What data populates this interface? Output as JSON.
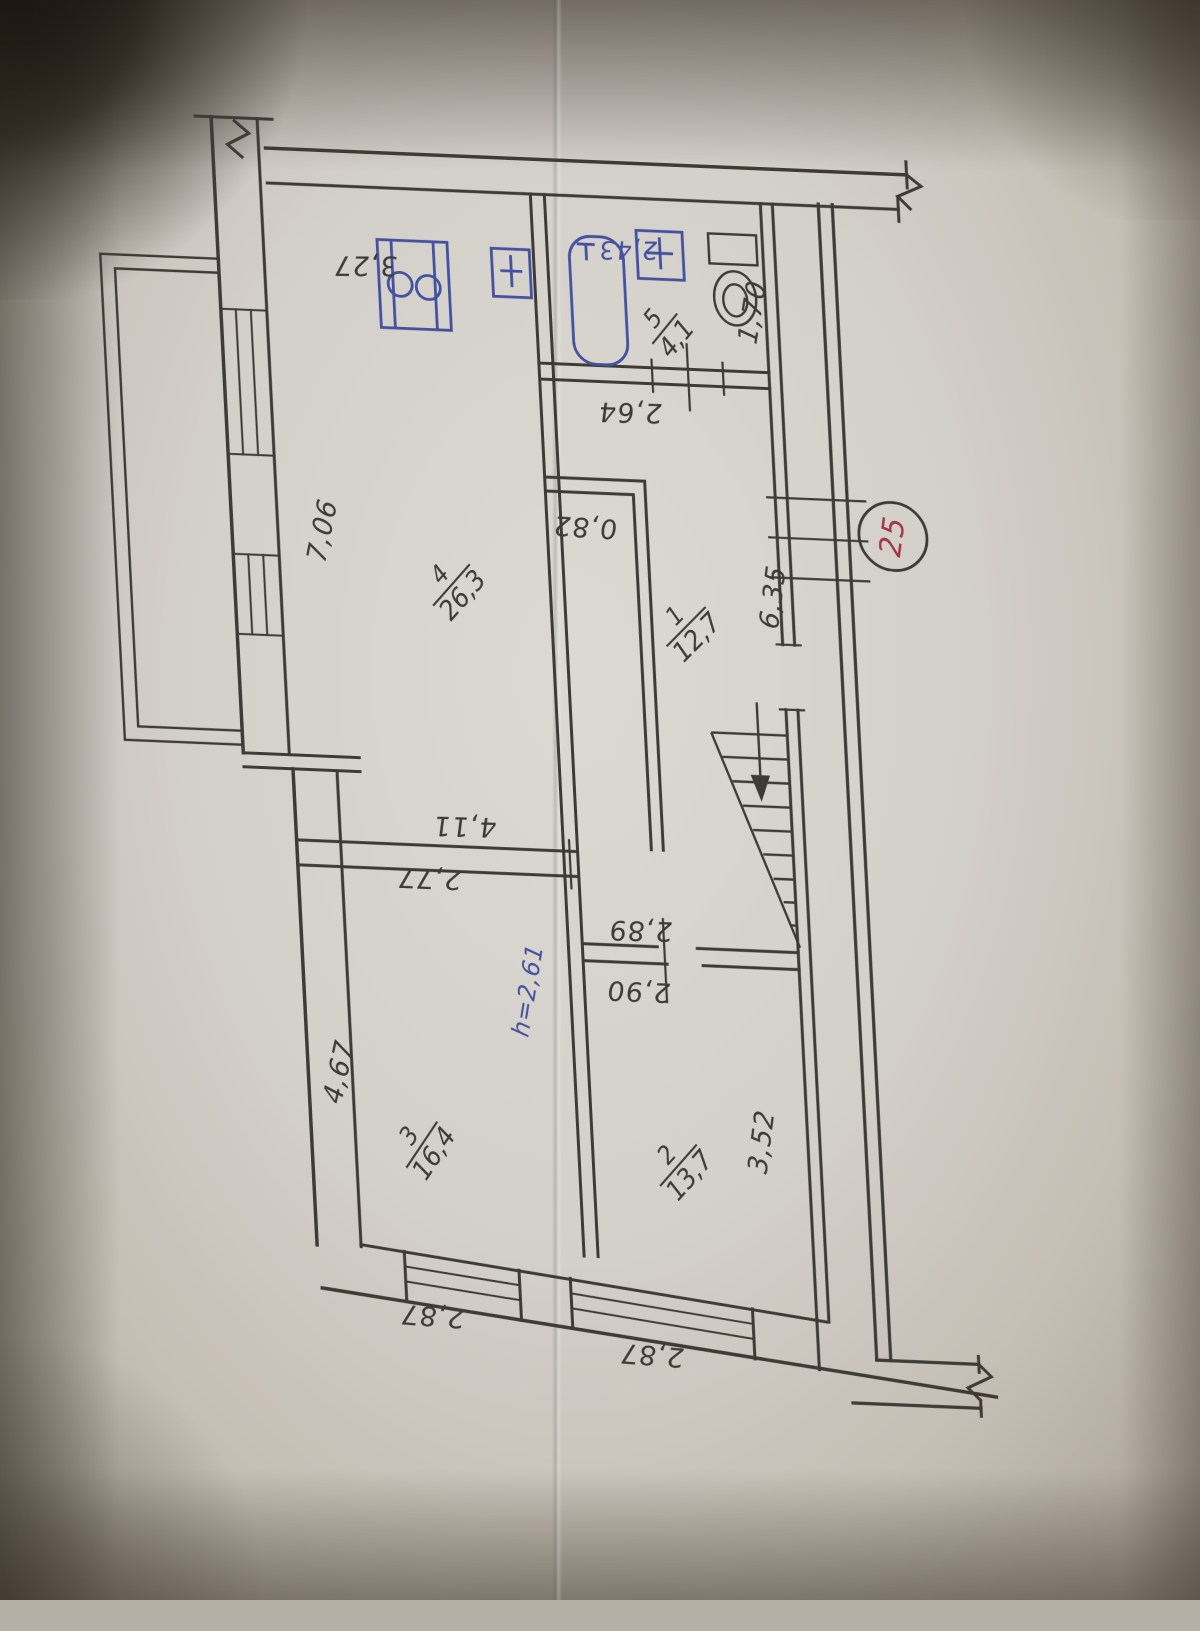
{
  "plan": {
    "apartment_number": "25",
    "ceiling_height_note": "h=2,61",
    "rooms": [
      {
        "number": "1",
        "area": "12,7"
      },
      {
        "number": "2",
        "area": "13,7"
      },
      {
        "number": "3",
        "area": "16,4"
      },
      {
        "number": "4",
        "area": "26,3"
      },
      {
        "number": "5",
        "area": "4,1"
      }
    ],
    "dimensions": {
      "top_wall": "3,27",
      "bath_blue": "2,43",
      "bath_door_wall": "2,64",
      "bath_width": "1,70",
      "left_wall_upper": "7,06",
      "closet_width": "0,82",
      "stair_wall": "6,35",
      "room4_bottom_a": "4,11",
      "room4_bottom_b": "2,77",
      "hall_wall_a": "2,89",
      "hall_wall_b": "2,90",
      "left_wall_lower": "4,67",
      "room2_right": "3,52",
      "window_left": "2,87",
      "window_right": "2,87"
    }
  },
  "colors": {
    "ink": "#3e3a35",
    "blue_ink": "#44519f",
    "red_ink": "#a2374a"
  }
}
